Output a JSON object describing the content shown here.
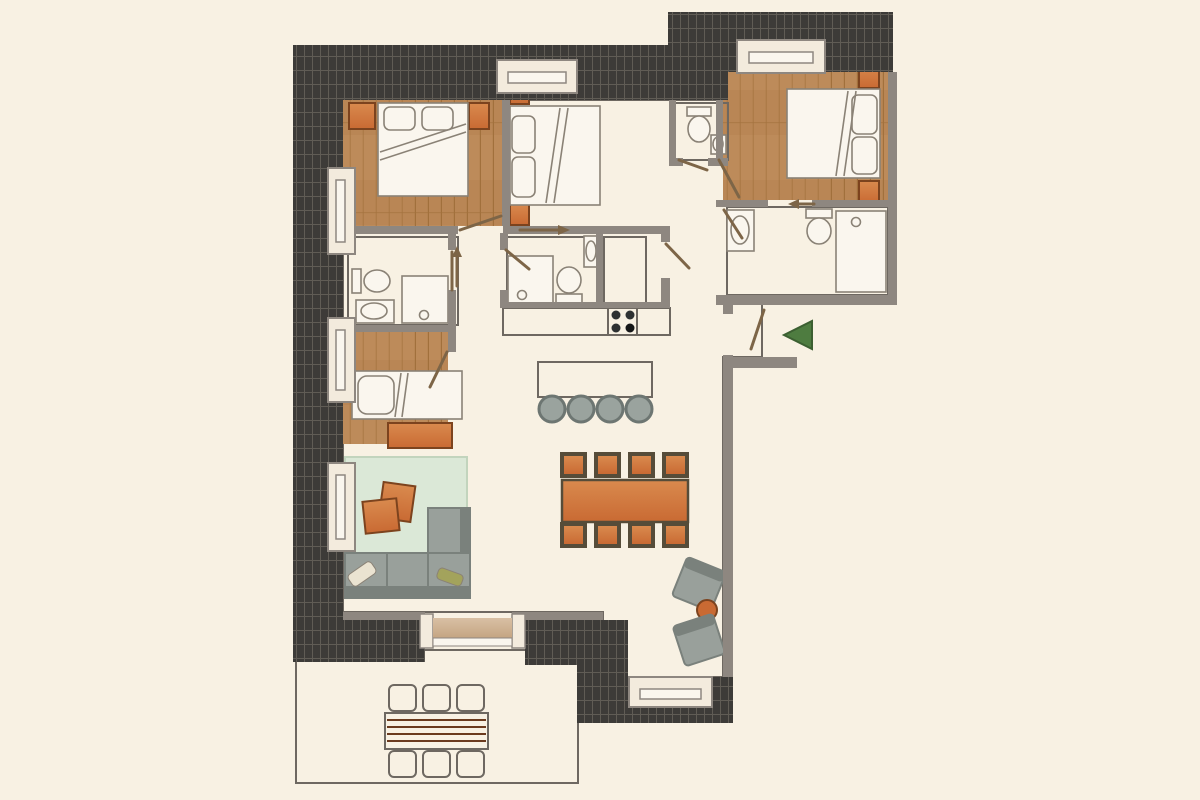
{
  "plan": {
    "type": "apartment-floor-plan",
    "rooms": [
      "bedroom-top-left",
      "bedroom-top-middle",
      "bedroom-top-right",
      "wc-small",
      "bathroom-right",
      "bathroom-center",
      "bathroom-left",
      "closet",
      "kitchen",
      "dining-area",
      "living-room",
      "single-bedroom",
      "hallway",
      "entrance",
      "terrace"
    ],
    "furniture": [
      "double-bed",
      "double-bed",
      "double-bed",
      "single-bed",
      "sofa-with-chaise",
      "rug",
      "coffee-tables",
      "dining-table-8-chairs",
      "kitchen-island-4-stools",
      "stove",
      "kitchen-counter",
      "wardrobe",
      "armchairs",
      "round-side-table",
      "outdoor-table-6-chairs",
      "toilets",
      "showers",
      "sinks",
      "dresser",
      "entrance-arrow"
    ]
  },
  "colors": {
    "background": "#f8f1e3",
    "hatch_base": "#3d3b38",
    "hatch_line": "#605c55",
    "wall": "#8e8780",
    "wall_dark": "#6e6861",
    "wood_base": "#bd8b5a",
    "wood_alt": "#b27e4b",
    "wood_line": "#a1703c",
    "tile_pink": "#e6d2c7",
    "tile_pink_line": "#f5ebe3",
    "terrace_tile": "#f6eee0",
    "terrace_line": "#c6b29a",
    "fixture_white": "#faf6ee",
    "fixture_outline": "#8a8276",
    "window_fill": "#f3ebdd",
    "orange": "#c96a33",
    "orange_light": "#d98a4e",
    "orange_deep": "#7c431e",
    "chair_frame": "#564c39",
    "rug": "#dbe8d7",
    "sofa": "#99a09b",
    "sofa_dark": "#7a817c",
    "pillow_cream": "#eae3d1",
    "pillow_olive": "#a3a35c",
    "counter_dark": "#4f5456",
    "counter_light": "#9ba0a2",
    "stove_panel": "#c9cccd",
    "burner": "#2e3132",
    "burner_dark": "#151617",
    "island_dark": "#54585b",
    "island_light": "#8f9598",
    "stool": "#9aa39e",
    "stool_ring": "#6d7672",
    "wardrobe_light": "#a75a2d",
    "wardrobe_dark": "#6e3413",
    "door_leaf": "#7d6547",
    "arrow_green": "#4e7c40",
    "threshold": "#d9c0a4",
    "threshold_dark": "#c2a27f",
    "terr_chair_light": "#b35c33",
    "terr_chair_dark": "#8a3f1d",
    "slat": "#6b3a1d"
  }
}
